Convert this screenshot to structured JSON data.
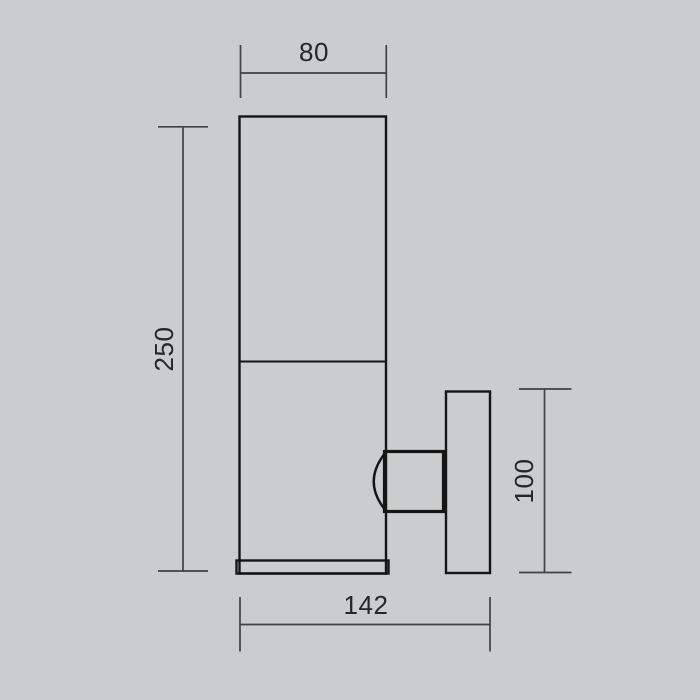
{
  "colors": {
    "background": "#cbcccd",
    "fixture_line": "#151515",
    "dimension_line": "#414141",
    "label_text": "#262626"
  },
  "diagram": {
    "type": "technical-dimension-drawing",
    "subject": "wall-mounted cylindrical sconce, side elevation",
    "dimensions": {
      "top_width": {
        "label": "80",
        "orientation": "horizontal",
        "measures": "lamp body diameter"
      },
      "left_height": {
        "label": "250",
        "orientation": "vertical",
        "measures": "lamp body height"
      },
      "right_height": {
        "label": "100",
        "orientation": "vertical",
        "measures": "wall plate height"
      },
      "bottom_depth": {
        "label": "142",
        "orientation": "horizontal",
        "measures": "overall projection depth"
      }
    }
  }
}
